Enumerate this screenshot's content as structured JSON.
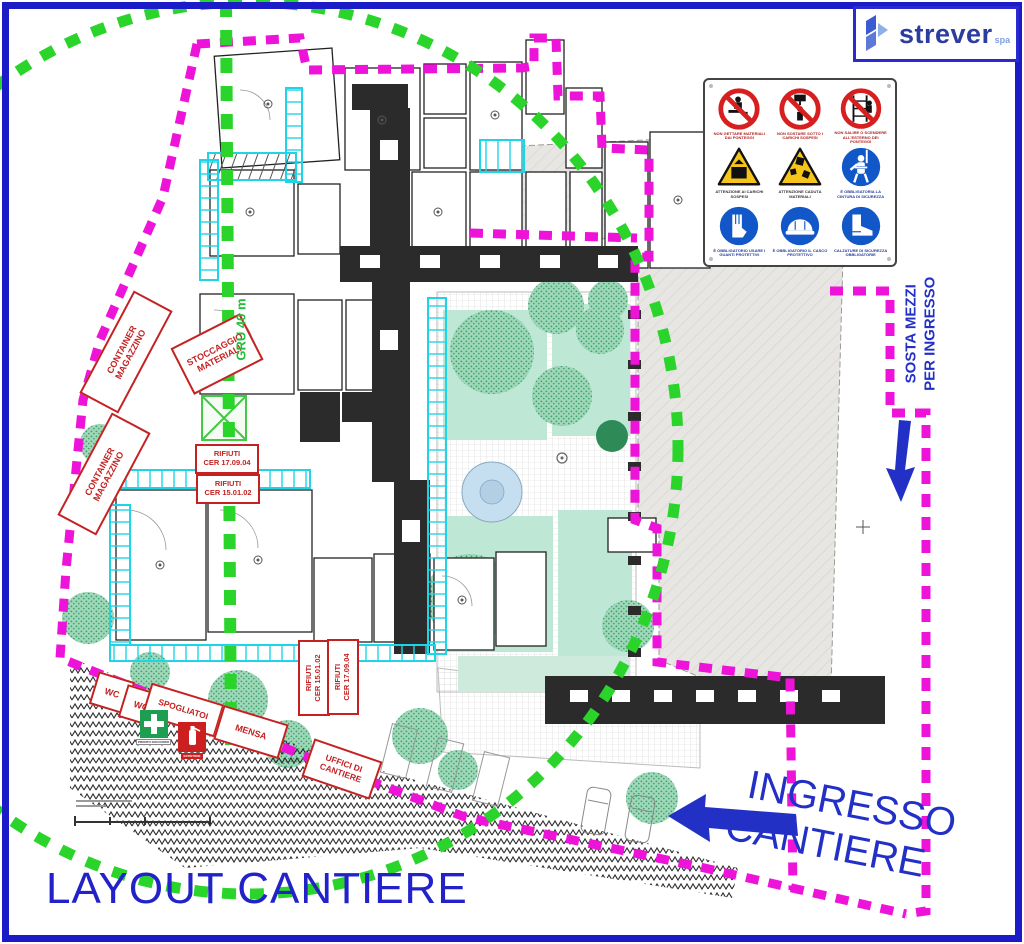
{
  "title": {
    "text": "LAYOUT CANTIERE"
  },
  "logo": {
    "brand": "strever",
    "suffix": "spa"
  },
  "entrance": {
    "line1": "INGRESSO",
    "line2": "CANTIERE"
  },
  "parking_note": {
    "line1": "SOSTA MEZZI",
    "line2": "PER INGRESSO"
  },
  "crane_label": {
    "text": "GRU 40 m"
  },
  "site_boxes": {
    "container1": {
      "line1": "CONTAINER",
      "line2": "MAGAZZINO"
    },
    "container2": {
      "line1": "CONTAINER",
      "line2": "MAGAZZINO"
    },
    "stoccaggio": {
      "line1": "STOCCAGGIO",
      "line2": "MATERIALI"
    },
    "rifiuti_a": {
      "line1": "RIFIUTI",
      "line2": "CER 17.09.04"
    },
    "rifiuti_b": {
      "line1": "RIFIUTI",
      "line2": "CER 15.01.02"
    },
    "rifiuti_c": {
      "line1": "RIFIUTI",
      "line2": "CER 15.01.02"
    },
    "rifiuti_d": {
      "line1": "RIFIUTI",
      "line2": "CER 17.09.04"
    },
    "wc1": {
      "text": "WC"
    },
    "wc2": {
      "text": "WC"
    },
    "spogliatoi": {
      "text": "SPOGLIATOI"
    },
    "mensa": {
      "text": "MENSA"
    },
    "uffici": {
      "line1": "UFFICI DI",
      "line2": "CANTIERE"
    }
  },
  "safety_signs": {
    "items": [
      {
        "type": "no-throw",
        "caption": "NON GETTARE MATERIALI DAI PONTEGGI"
      },
      {
        "type": "no-stand",
        "caption": "NON SOSTARE SOTTO I CARICHI SOSPESI"
      },
      {
        "type": "no-climb",
        "caption": "NON SALIRE O SCENDERE ALL'ESTERNO DEI PONTEGGI"
      },
      {
        "type": "warn-load",
        "caption": "ATTENZIONE AI CARICHI SOSPESI"
      },
      {
        "type": "warn-fall",
        "caption": "ATTENZIONE CADUTA MATERIALI"
      },
      {
        "type": "harness",
        "caption": "È OBBLIGATORIA LA CINTURA DI SICUREZZA"
      },
      {
        "type": "gloves",
        "caption": "È OBBLIGATORIO USARE I GUANTI PROTETTIVI"
      },
      {
        "type": "helmet",
        "caption": "È OBBLIGATORIO IL CASCO PROTETTIVO"
      },
      {
        "type": "boots",
        "caption": "CALZATURE DI SICUREZZA OBBLIGATORIE"
      }
    ]
  },
  "aid_signs": {
    "first_aid": "PRONTO SOCCORSO",
    "extinguisher": "ESTINTORE"
  },
  "colors": {
    "boundary": "#ee13d8",
    "crane": "#2bd42b",
    "scaffold": "#1fd4e6",
    "accent_blue": "#2330c6",
    "label_red": "#c42222"
  }
}
